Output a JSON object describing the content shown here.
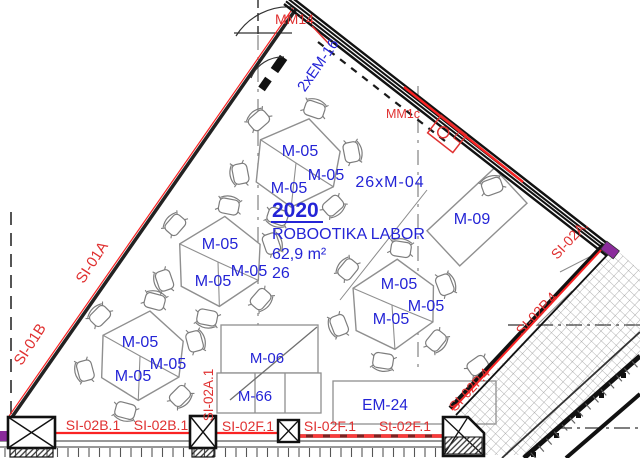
{
  "room": {
    "number": "2020",
    "name": "ROBOOTIKA LABOR",
    "area": "62,9 m²",
    "occupancy": "26"
  },
  "labels": {
    "table": "M-05",
    "chair_count": "26xM-04",
    "teacher_desk": "M-09",
    "cabinet_top": "M-06",
    "cabinet_bottom": "M-66",
    "equipment_rail": "EM-24",
    "door_top": "MM14",
    "device_right": "MM1c",
    "wall_east": "2xEM-16"
  },
  "wall_tags": {
    "nw_upper": "SI-01A",
    "nw_lower": "SI-01B",
    "south_b1": "SI-02B.1",
    "south_b2": "SI-02B.1",
    "south_vert": "SI-02A.1",
    "south_f1": "SI-02F.1",
    "south_f2": "SI-02F.1",
    "south_f3": "St-02F.1",
    "se_corner": "SI-02A.",
    "se_p1": "SI-02P.4",
    "se_p2": "SI-02P.4"
  },
  "colors": {
    "annotation_blue": "#2424d6",
    "annotation_red": "#e03131",
    "line_red": "#fa2323",
    "wall_dark": "#1c1c1c",
    "furniture_gray": "#8f8f8f",
    "grid_gray": "#8c8c8c",
    "accent_purple": "#8a2b9b"
  }
}
